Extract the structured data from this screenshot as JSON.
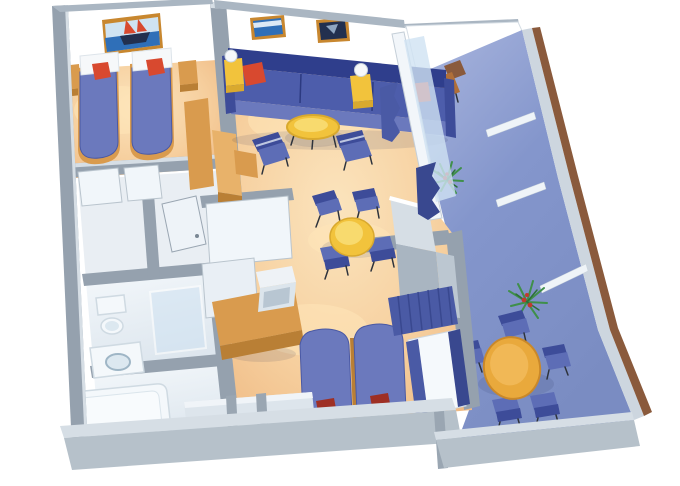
{
  "scene": {
    "description": "3D isometric cutaway floor plan of a two-bedroom cruise ship suite with a private balcony",
    "view": "isometric-cutaway",
    "background": "#ffffff"
  },
  "palette": {
    "wall_gray": "#95a1ae",
    "wall_cap": "#d6dee5",
    "wall_edge": "#aab6c2",
    "wall_face": "#ffffff",
    "bench_gray": "#dde5ec",
    "carpet": "#f2c28e",
    "carpet_light": "#fbe4bd",
    "deck": "#8092c6",
    "deck_light": "#aab6de",
    "wood": "#d99b4e",
    "wood_dark": "#b97f35",
    "wood_light": "#e8b26a",
    "table_yellow": "#f2c33c",
    "table_rim": "#d9a92e",
    "lamp_white": "#f6f8fa",
    "sofa_blue": "#4d5dab",
    "sofa_dark": "#2f3e8c",
    "sofa_light": "#6b79bd",
    "chair_blue": "#5d6db6",
    "chair_back": "#3d4c99",
    "bed_spread": "#6b79bd",
    "bed_edge": "#4a59a4",
    "pillow_red": "#d8492f",
    "pillow_dark_red": "#9e2f24",
    "fixture_white": "#f4f8fb",
    "fixture_shadow": "#cfdae2",
    "glass_blue": "#cfe2f2",
    "curtain_blue": "#4a5aa5",
    "curtain_dark": "#39488f",
    "plant_green": "#3f8f4a",
    "plant_dark": "#2d7038",
    "plant_red": "#c03a2e",
    "railing_brown": "#8a5a3c",
    "frame_wood": "#c8872f",
    "sea_blue": "#2f6fb8",
    "sky_blue": "#cfe3f2",
    "painting_dark": "#22304f"
  },
  "rooms": [
    {
      "id": "twin-bedroom",
      "furniture": [
        "twin-bed",
        "twin-bed",
        "white-pillow",
        "white-pillow",
        "red-pillow",
        "red-pillow",
        "nightstand",
        "nightstand",
        "sailboat-painting",
        "wardrobe"
      ]
    },
    {
      "id": "living-room",
      "furniture": [
        "sofa-3-seat",
        "red-pillow",
        "red-pillow",
        "side-table-lamp",
        "side-table-lamp",
        "coffee-table",
        "armchair",
        "armchair",
        "seascape-painting",
        "dark-painting",
        "dining-table",
        "dining-chair",
        "dining-chair",
        "dining-chair",
        "dining-chair"
      ]
    },
    {
      "id": "master-bedroom",
      "furniture": [
        "bed",
        "bed",
        "dark-red-pillow",
        "dark-red-pillow",
        "desk",
        "tv",
        "window-curtains",
        "wardrobe-block",
        "window-bench"
      ]
    },
    {
      "id": "closet-hall",
      "furniture": [
        "closet-door",
        "closet-door",
        "open-door",
        "closet-rods"
      ]
    },
    {
      "id": "bathroom-shower",
      "furniture": [
        "toilet",
        "shower"
      ]
    },
    {
      "id": "bathroom-tub",
      "furniture": [
        "sink",
        "bathtub"
      ]
    },
    {
      "id": "balcony",
      "furniture": [
        "lounge-chair",
        "plant",
        "plant",
        "round-table",
        "deck-chair",
        "deck-chair",
        "deck-chair",
        "deck-chair",
        "deck-chair",
        "railing",
        "privacy-partition"
      ]
    }
  ],
  "counts": {
    "beds_total": 4,
    "paintings": 3,
    "red_pillows": 4,
    "dark_red_pillows": 2,
    "armchairs": 2,
    "dining_chairs": 4,
    "balcony_chairs": 5,
    "plants": 2,
    "lamps": 2,
    "tables": 3
  }
}
